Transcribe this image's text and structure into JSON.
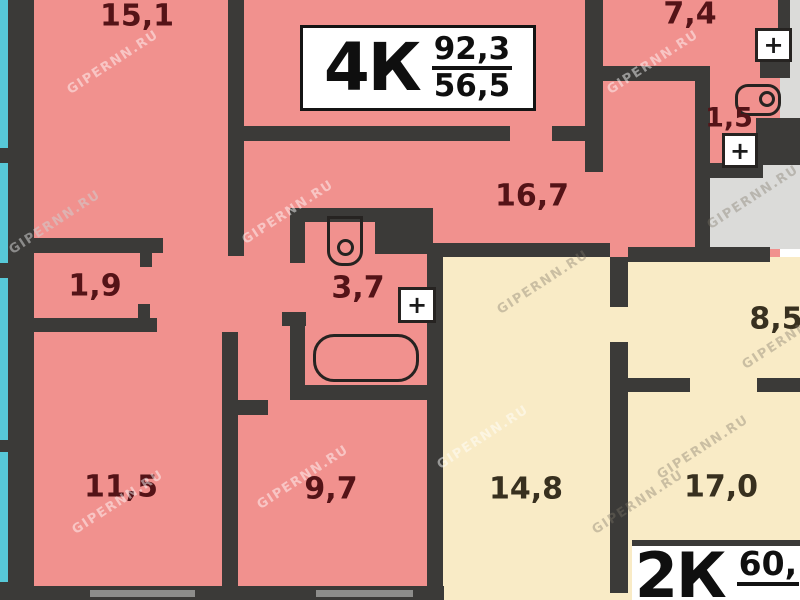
{
  "watermark": {
    "text": "GIPERNN.RU"
  },
  "palette": {
    "apartment_4k_fill": "#f1918e",
    "apartment_2k_fill": "#f9ebc6",
    "balcony_strip": "#57c8d7",
    "wall": "#3b3a38",
    "stairwell_fill": "#dbdbd9",
    "window_segment": "#8d8d8b",
    "label_on_pink": "#541317",
    "label_on_yellow": "#38301f"
  },
  "apartments": [
    {
      "id": "4k",
      "type_label": "4К",
      "area_total": "92,3",
      "area_living": "56,5"
    },
    {
      "id": "2k",
      "type_label": "2К",
      "area_total": "60,",
      "area_living": ""
    }
  ],
  "rooms": [
    {
      "label": "15,1",
      "x": 137,
      "y": 16,
      "tone": "pink",
      "size": 30
    },
    {
      "label": "7,4",
      "x": 690,
      "y": 14,
      "tone": "pink",
      "size": 30
    },
    {
      "label": "1,5",
      "x": 729,
      "y": 118,
      "tone": "pink",
      "size": 27
    },
    {
      "label": "16,7",
      "x": 532,
      "y": 196,
      "tone": "pink",
      "size": 30
    },
    {
      "label": "1,9",
      "x": 95,
      "y": 286,
      "tone": "pink",
      "size": 30
    },
    {
      "label": "3,7",
      "x": 358,
      "y": 288,
      "tone": "pink",
      "size": 30
    },
    {
      "label": "8,5",
      "x": 776,
      "y": 319,
      "tone": "yellow",
      "size": 30
    },
    {
      "label": "11,5",
      "x": 121,
      "y": 487,
      "tone": "pink",
      "size": 30
    },
    {
      "label": "9,7",
      "x": 331,
      "y": 489,
      "tone": "pink",
      "size": 30
    },
    {
      "label": "14,8",
      "x": 526,
      "y": 489,
      "tone": "yellow",
      "size": 30
    },
    {
      "label": "17,0",
      "x": 721,
      "y": 487,
      "tone": "yellow",
      "size": 30
    }
  ],
  "icons": {
    "plus_glyph": "+"
  }
}
